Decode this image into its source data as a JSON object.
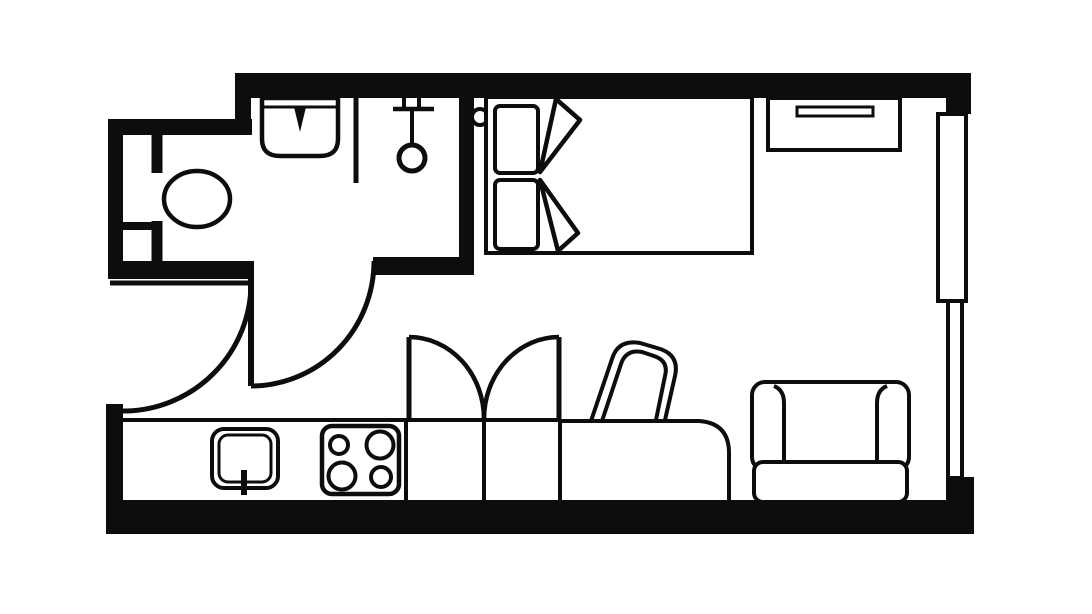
{
  "meta": {
    "canvas": {
      "w": 1092,
      "h": 614
    }
  },
  "colors": {
    "ink": "#0d0d0d",
    "paper": "#ffffff"
  },
  "shapes": [
    {
      "name": "wall-top",
      "kind": "rect",
      "attrs": {
        "x": 235,
        "y": 73,
        "width": 735,
        "height": 25,
        "fill": "ink"
      }
    },
    {
      "name": "wall-top-step",
      "kind": "rect",
      "attrs": {
        "x": 235,
        "y": 73,
        "width": 16,
        "height": 62,
        "fill": "ink"
      }
    },
    {
      "name": "wall-bathroom-top",
      "kind": "rect",
      "attrs": {
        "x": 108,
        "y": 119,
        "width": 144,
        "height": 16,
        "fill": "ink"
      }
    },
    {
      "name": "wall-left-bathroom",
      "kind": "rect",
      "attrs": {
        "x": 108,
        "y": 119,
        "width": 15,
        "height": 160,
        "fill": "ink"
      }
    },
    {
      "name": "wall-bathroom-bottom-left",
      "kind": "rect",
      "attrs": {
        "x": 108,
        "y": 261,
        "width": 144,
        "height": 18,
        "fill": "ink"
      }
    },
    {
      "name": "wall-bathroom-right",
      "kind": "rect",
      "attrs": {
        "x": 459,
        "y": 97,
        "width": 15,
        "height": 178,
        "fill": "ink"
      }
    },
    {
      "name": "wall-bathroom-bottom-right",
      "kind": "rect",
      "attrs": {
        "x": 373,
        "y": 257,
        "width": 101,
        "height": 18,
        "fill": "ink"
      }
    },
    {
      "name": "wall-left-pier",
      "kind": "rect",
      "attrs": {
        "x": 106,
        "y": 404,
        "width": 17,
        "height": 130,
        "fill": "ink"
      }
    },
    {
      "name": "wall-bottom",
      "kind": "rect",
      "attrs": {
        "x": 106,
        "y": 500,
        "width": 868,
        "height": 34,
        "fill": "ink"
      }
    },
    {
      "name": "wall-corner-top-right",
      "kind": "rect",
      "attrs": {
        "x": 946,
        "y": 73,
        "width": 25,
        "height": 41,
        "fill": "ink"
      }
    },
    {
      "name": "wall-corner-bottom-right",
      "kind": "rect",
      "attrs": {
        "x": 946,
        "y": 477,
        "width": 28,
        "height": 57,
        "fill": "ink"
      }
    },
    {
      "name": "window-upper",
      "kind": "rect",
      "attrs": {
        "x": 938,
        "y": 114,
        "width": 28,
        "height": 187,
        "fill": "none",
        "stroke": "ink",
        "stroke-width": 4
      }
    },
    {
      "name": "window-lower",
      "kind": "rect",
      "attrs": {
        "x": 948,
        "y": 301,
        "width": 14,
        "height": 177,
        "fill": "none",
        "stroke": "ink",
        "stroke-width": 4
      }
    },
    {
      "name": "entry-door-leaf",
      "kind": "line",
      "attrs": {
        "x1": 110,
        "y1": 283,
        "x2": 251,
        "y2": 283,
        "stroke": "ink",
        "stroke-width": 5
      }
    },
    {
      "name": "entry-door-swing-arc",
      "kind": "path",
      "attrs": {
        "d": "M 251 283 A 128 128 0 0 1 123 411",
        "fill": "none",
        "stroke": "ink",
        "stroke-width": 5
      }
    },
    {
      "name": "hall-door-leaf",
      "kind": "line",
      "attrs": {
        "x1": 251,
        "y1": 261,
        "x2": 251,
        "y2": 386,
        "stroke": "ink",
        "stroke-width": 6
      }
    },
    {
      "name": "hall-door-swing-arc",
      "kind": "path",
      "attrs": {
        "d": "M 374 261 A 123 125 0 0 1 251 386",
        "fill": "none",
        "stroke": "ink",
        "stroke-width": 5
      }
    },
    {
      "name": "bathroom-partition",
      "kind": "line",
      "attrs": {
        "x1": 157,
        "y1": 135,
        "x2": 157,
        "y2": 261,
        "stroke": "ink",
        "stroke-width": 11
      }
    },
    {
      "name": "bathroom-shelf-divider",
      "kind": "line",
      "attrs": {
        "x1": 122,
        "y1": 226,
        "x2": 152,
        "y2": 226,
        "stroke": "ink",
        "stroke-width": 8
      }
    },
    {
      "name": "toilet-cistern",
      "kind": "rect",
      "attrs": {
        "x": 151,
        "y": 173,
        "width": 13,
        "height": 48,
        "fill": "paper"
      }
    },
    {
      "name": "toilet-bowl",
      "kind": "ellipse",
      "attrs": {
        "cx": 197,
        "cy": 199,
        "rx": 33,
        "ry": 28,
        "fill": "paper",
        "stroke": "ink",
        "stroke-width": 4.5
      }
    },
    {
      "name": "sink-basin",
      "kind": "path",
      "attrs": {
        "d": "M 262 98 L 338 98 L 338 139 Q 338 156 320 156 L 280 156 Q 262 156 262 139 Z",
        "fill": "paper",
        "stroke": "ink",
        "stroke-width": 4.5
      }
    },
    {
      "name": "sink-rim",
      "kind": "line",
      "attrs": {
        "x1": 262,
        "y1": 107,
        "x2": 338,
        "y2": 107,
        "stroke": "ink",
        "stroke-width": 3
      }
    },
    {
      "name": "sink-faucet",
      "kind": "polygon",
      "attrs": {
        "points": "294,107 306,107 300,132",
        "fill": "ink"
      }
    },
    {
      "name": "shower-partition",
      "kind": "line",
      "attrs": {
        "x1": 356,
        "y1": 98,
        "x2": 356,
        "y2": 183,
        "stroke": "ink",
        "stroke-width": 5
      }
    },
    {
      "name": "shower-bracket-tick-left",
      "kind": "line",
      "attrs": {
        "x1": 404,
        "y1": 94,
        "x2": 404,
        "y2": 109,
        "stroke": "ink",
        "stroke-width": 4
      }
    },
    {
      "name": "shower-bracket-tick-right",
      "kind": "line",
      "attrs": {
        "x1": 419,
        "y1": 92,
        "x2": 419,
        "y2": 107,
        "stroke": "ink",
        "stroke-width": 4
      }
    },
    {
      "name": "shower-rail",
      "kind": "line",
      "attrs": {
        "x1": 393,
        "y1": 109,
        "x2": 434,
        "y2": 109,
        "stroke": "ink",
        "stroke-width": 4.5
      }
    },
    {
      "name": "shower-hose",
      "kind": "line",
      "attrs": {
        "x1": 412,
        "y1": 109,
        "x2": 412,
        "y2": 147,
        "stroke": "ink",
        "stroke-width": 4
      }
    },
    {
      "name": "shower-head",
      "kind": "circle",
      "attrs": {
        "cx": 412,
        "cy": 158,
        "r": 13,
        "fill": "paper",
        "stroke": "ink",
        "stroke-width": 5
      }
    },
    {
      "name": "door-knob",
      "kind": "circle",
      "attrs": {
        "cx": 480,
        "cy": 117,
        "r": 8,
        "fill": "paper",
        "stroke": "ink",
        "stroke-width": 4
      }
    },
    {
      "name": "bed-frame",
      "kind": "rect",
      "attrs": {
        "x": 486,
        "y": 97,
        "width": 266,
        "height": 156,
        "fill": "paper",
        "stroke": "ink",
        "stroke-width": 4
      }
    },
    {
      "name": "bed-pillow-top",
      "kind": "rect",
      "attrs": {
        "x": 495,
        "y": 106,
        "width": 43,
        "height": 67,
        "rx": 5,
        "fill": "paper",
        "stroke": "ink",
        "stroke-width": 4
      }
    },
    {
      "name": "bed-pillow-bottom",
      "kind": "rect",
      "attrs": {
        "x": 495,
        "y": 180,
        "width": 43,
        "height": 69,
        "rx": 5,
        "fill": "paper",
        "stroke": "ink",
        "stroke-width": 4
      }
    },
    {
      "name": "bed-duvet-fold-top",
      "kind": "polygon",
      "attrs": {
        "points": "556,99 580,120 540,172",
        "fill": "paper",
        "stroke": "ink",
        "stroke-width": 4.5,
        "stroke-linejoin": "round"
      }
    },
    {
      "name": "bed-duvet-fold-bottom",
      "kind": "polygon",
      "attrs": {
        "points": "540,180 578,233 558,251",
        "fill": "paper",
        "stroke": "ink",
        "stroke-width": 4.5,
        "stroke-linejoin": "round"
      }
    },
    {
      "name": "dresser",
      "kind": "rect",
      "attrs": {
        "x": 768,
        "y": 98,
        "width": 132,
        "height": 52,
        "fill": "paper",
        "stroke": "ink",
        "stroke-width": 4
      }
    },
    {
      "name": "dresser-drawer-slot",
      "kind": "rect",
      "attrs": {
        "x": 797,
        "y": 107,
        "width": 76,
        "height": 9,
        "fill": "paper",
        "stroke": "ink",
        "stroke-width": 3
      }
    },
    {
      "name": "kitchen-counter-edge",
      "kind": "line",
      "attrs": {
        "x1": 122,
        "y1": 420,
        "x2": 406,
        "y2": 420,
        "stroke": "ink",
        "stroke-width": 4
      }
    },
    {
      "name": "kitchen-counter-divider",
      "kind": "line",
      "attrs": {
        "x1": 406,
        "y1": 420,
        "x2": 406,
        "y2": 500,
        "stroke": "ink",
        "stroke-width": 4
      }
    },
    {
      "name": "kitchen-sink-outer",
      "kind": "rect",
      "attrs": {
        "x": 212,
        "y": 429,
        "width": 66,
        "height": 59,
        "rx": 12,
        "fill": "paper",
        "stroke": "ink",
        "stroke-width": 4
      }
    },
    {
      "name": "kitchen-sink-inner",
      "kind": "rect",
      "attrs": {
        "x": 219,
        "y": 435,
        "width": 52,
        "height": 47,
        "rx": 9,
        "fill": "none",
        "stroke": "ink",
        "stroke-width": 3
      }
    },
    {
      "name": "kitchen-sink-faucet",
      "kind": "line",
      "attrs": {
        "x1": 244,
        "y1": 470,
        "x2": 244,
        "y2": 495,
        "stroke": "ink",
        "stroke-width": 6
      }
    },
    {
      "name": "stove",
      "kind": "rect",
      "attrs": {
        "x": 322,
        "y": 426,
        "width": 77,
        "height": 68,
        "rx": 10,
        "fill": "paper",
        "stroke": "ink",
        "stroke-width": 4.5
      }
    },
    {
      "name": "stove-burner-top-left",
      "kind": "circle",
      "attrs": {
        "cx": 339,
        "cy": 445,
        "r": 9,
        "fill": "none",
        "stroke": "ink",
        "stroke-width": 4
      }
    },
    {
      "name": "stove-burner-top-right",
      "kind": "circle",
      "attrs": {
        "cx": 380,
        "cy": 445,
        "r": 13.5,
        "fill": "none",
        "stroke": "ink",
        "stroke-width": 4
      }
    },
    {
      "name": "stove-burner-bottom-left",
      "kind": "circle",
      "attrs": {
        "cx": 342,
        "cy": 476,
        "r": 13.5,
        "fill": "none",
        "stroke": "ink",
        "stroke-width": 4
      }
    },
    {
      "name": "stove-burner-bottom-right",
      "kind": "circle",
      "attrs": {
        "cx": 381,
        "cy": 477,
        "r": 10,
        "fill": "none",
        "stroke": "ink",
        "stroke-width": 4
      }
    },
    {
      "name": "wardrobe-front-edge",
      "kind": "line",
      "attrs": {
        "x1": 406,
        "y1": 420,
        "x2": 560,
        "y2": 420,
        "stroke": "ink",
        "stroke-width": 4
      }
    },
    {
      "name": "wardrobe-divider",
      "kind": "line",
      "attrs": {
        "x1": 484,
        "y1": 420,
        "x2": 484,
        "y2": 500,
        "stroke": "ink",
        "stroke-width": 4
      }
    },
    {
      "name": "wardrobe-door-left-leaf",
      "kind": "line",
      "attrs": {
        "x1": 409,
        "y1": 337,
        "x2": 409,
        "y2": 420,
        "stroke": "ink",
        "stroke-width": 5
      }
    },
    {
      "name": "wardrobe-door-left-arc",
      "kind": "path",
      "attrs": {
        "d": "M 409 337 A 75 82 0 0 1 484 419",
        "fill": "none",
        "stroke": "ink",
        "stroke-width": 4.5
      }
    },
    {
      "name": "wardrobe-door-right-leaf",
      "kind": "line",
      "attrs": {
        "x1": 559,
        "y1": 337,
        "x2": 559,
        "y2": 420,
        "stroke": "ink",
        "stroke-width": 5
      }
    },
    {
      "name": "wardrobe-door-right-arc",
      "kind": "path",
      "attrs": {
        "d": "M 559 337 A 75 82 0 0 0 484 419",
        "fill": "none",
        "stroke": "ink",
        "stroke-width": 4.5
      }
    },
    {
      "name": "desk",
      "kind": "path",
      "attrs": {
        "d": "M 560 500 L 560 421 L 699 421 Q 729 423 729 453 L 729 500",
        "fill": "paper",
        "stroke": "ink",
        "stroke-width": 4
      }
    },
    {
      "name": "desk-chair-back-outer",
      "kind": "path",
      "attrs": {
        "d": "M 591 421 L 612 359 Q 618 339 640 343 L 657 348 Q 680 354 675 376 L 665 420",
        "fill": "none",
        "stroke": "ink",
        "stroke-width": 4,
        "stroke-linejoin": "round"
      }
    },
    {
      "name": "desk-chair-back-inner",
      "kind": "path",
      "attrs": {
        "d": "M 602 421 L 621 364 Q 626 349 642 352 L 654 356 Q 669 361 665 376 L 656 420",
        "fill": "none",
        "stroke": "ink",
        "stroke-width": 4,
        "stroke-linejoin": "round"
      }
    },
    {
      "name": "armchair-body",
      "kind": "rect",
      "attrs": {
        "x": 752,
        "y": 382,
        "width": 157,
        "height": 88,
        "rx": 13,
        "fill": "paper",
        "stroke": "ink",
        "stroke-width": 4
      }
    },
    {
      "name": "armchair-arm-left",
      "kind": "path",
      "attrs": {
        "d": "M 784 466 L 784 403 Q 784 390 774 386",
        "fill": "none",
        "stroke": "ink",
        "stroke-width": 4
      }
    },
    {
      "name": "armchair-arm-right",
      "kind": "path",
      "attrs": {
        "d": "M 877 466 L 877 403 Q 877 390 887 386",
        "fill": "none",
        "stroke": "ink",
        "stroke-width": 4
      }
    },
    {
      "name": "armchair-seat-cushion",
      "kind": "rect",
      "attrs": {
        "x": 754,
        "y": 462,
        "width": 153,
        "height": 40,
        "rx": 9,
        "fill": "paper",
        "stroke": "ink",
        "stroke-width": 4
      }
    }
  ]
}
